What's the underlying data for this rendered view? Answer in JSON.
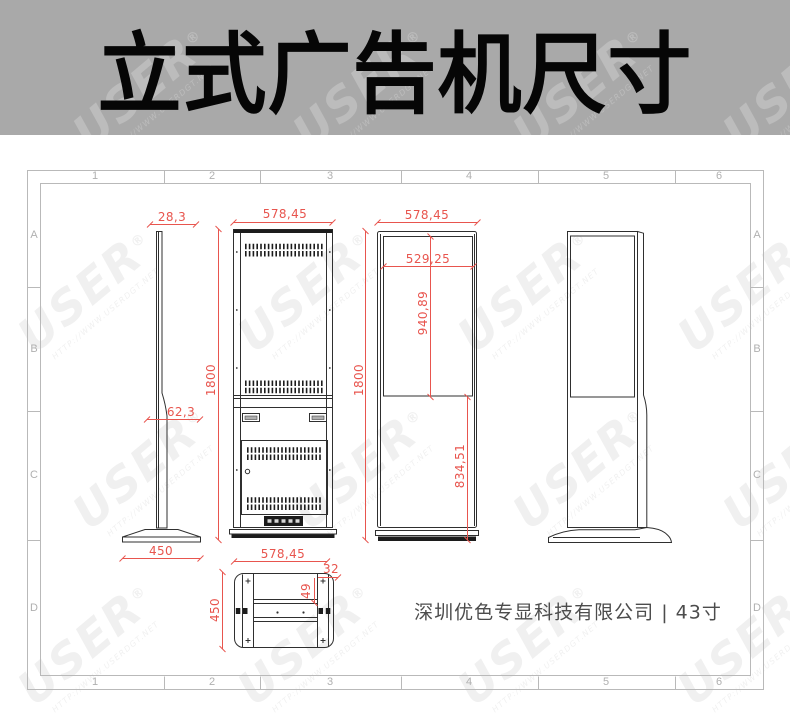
{
  "banner": {
    "title": "立式广告机尺寸"
  },
  "frame": {
    "columns": [
      "1",
      "2",
      "3",
      "4",
      "5",
      "6"
    ],
    "rows": [
      "A",
      "B",
      "C",
      "D"
    ]
  },
  "dimensions": {
    "side_top_thickness": "28,3",
    "side_lower_thickness": "62,3",
    "back_height": "1800",
    "base_depth": "450",
    "back_width": "578,45",
    "front_width": "578,45",
    "front_height": "1800",
    "screen_width": "529,25",
    "screen_height": "940,89",
    "lower_section_height": "834,51",
    "bottom_width": "578,45",
    "bottom_depth": "450",
    "bottom_side_panel": "32",
    "bottom_offset": "49"
  },
  "footer": {
    "text": "深圳优色专显科技有限公司 | 43寸"
  },
  "watermark": {
    "brand": "USER",
    "reg": "®",
    "url": "HTTP://WWW.USERDGT.NET"
  },
  "colors": {
    "dimension_red": "#e8554e",
    "banner_bg": "#a9a9a9",
    "line_dark": "#2f2f2f"
  }
}
